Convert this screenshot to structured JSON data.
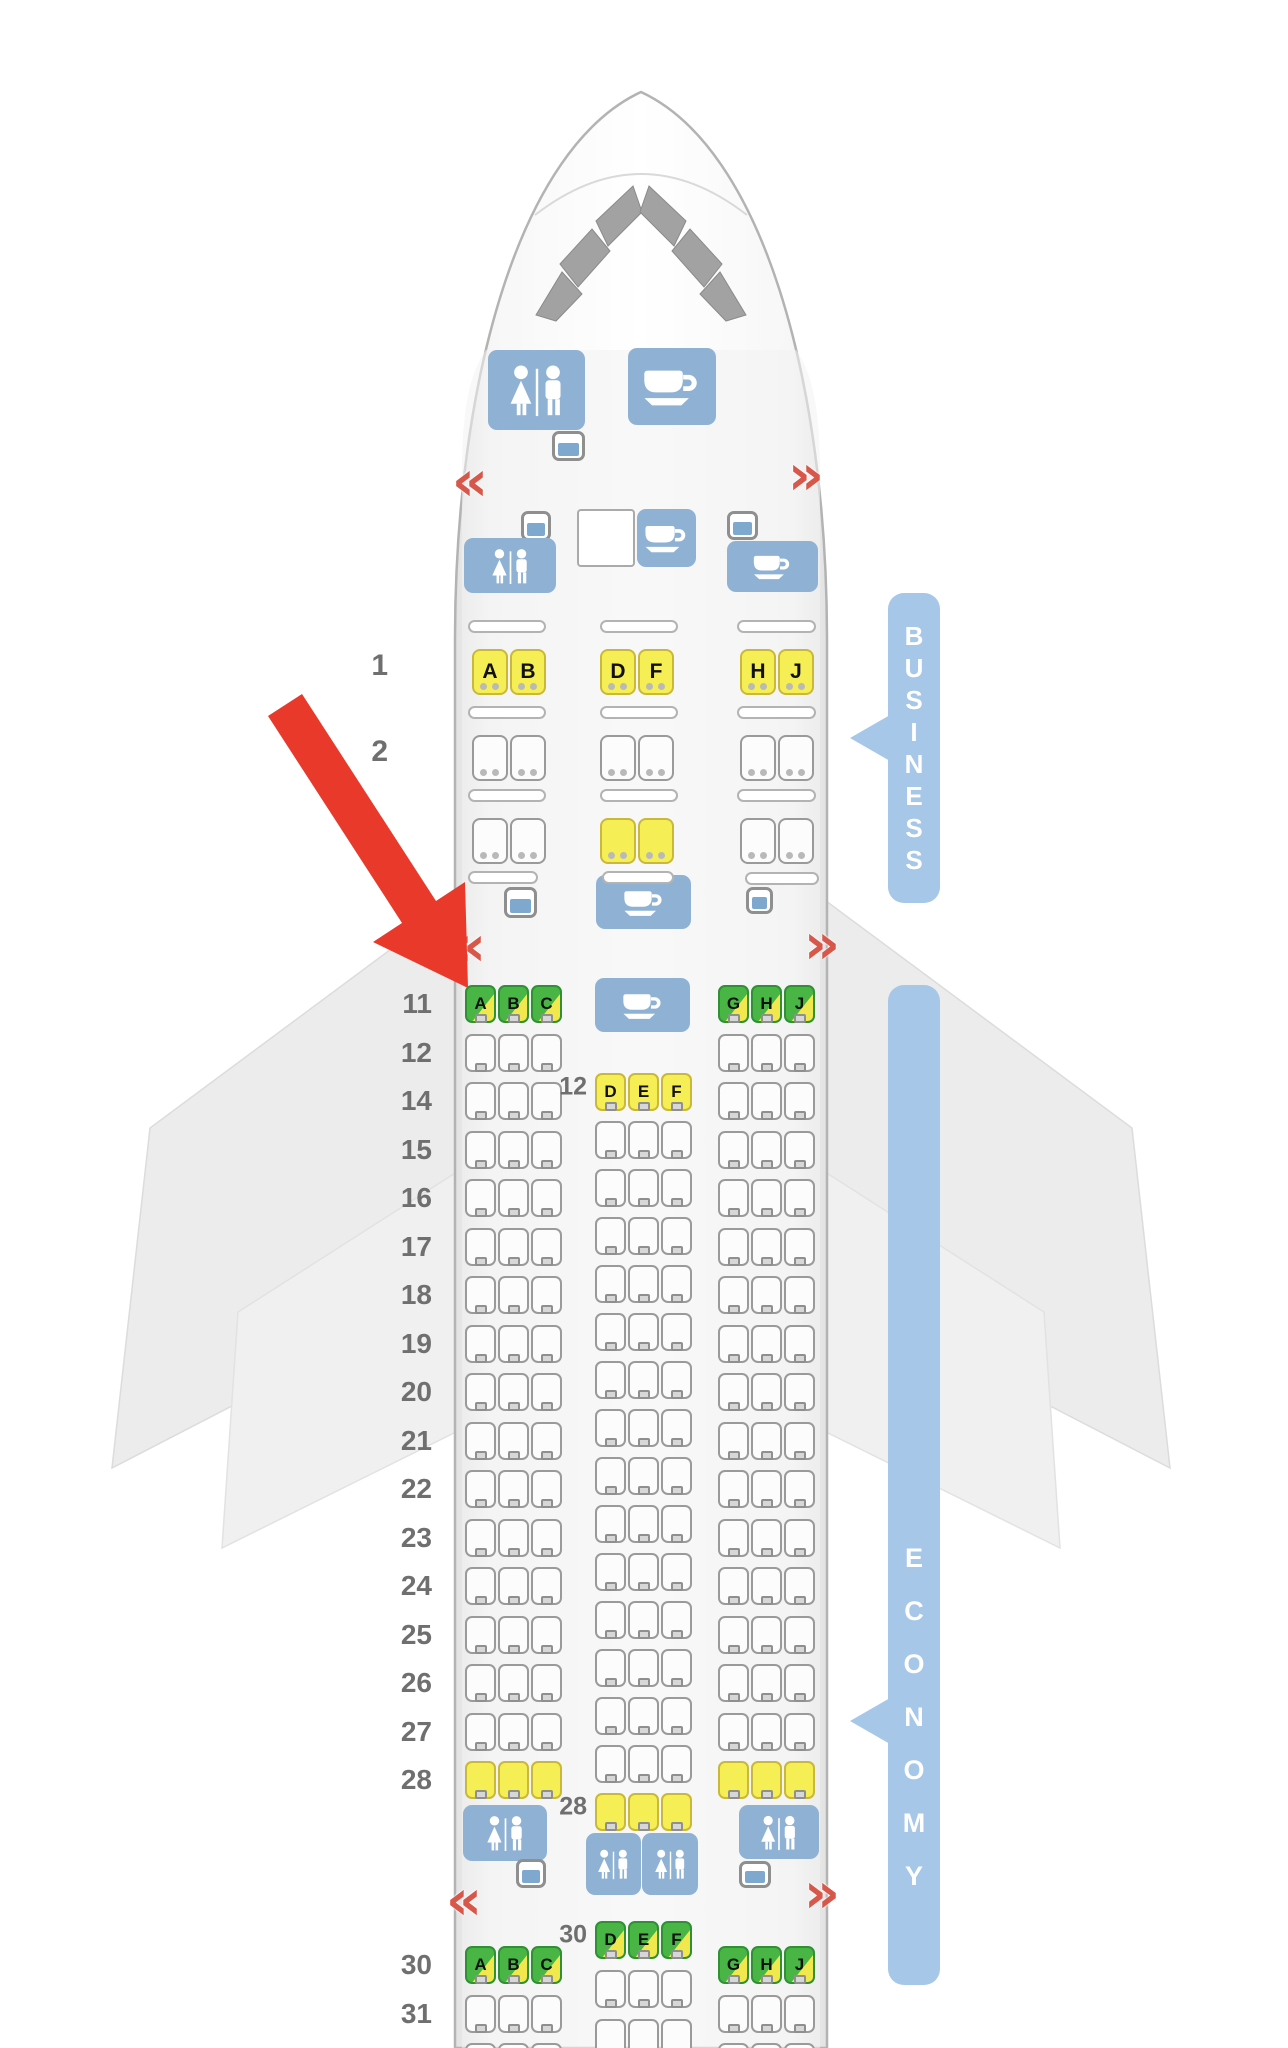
{
  "seat_map": {
    "banners": {
      "business": {
        "label": "BUSINESS",
        "color": "#a7c7e8",
        "text_color": "#ffffff"
      },
      "economy": {
        "label": "ECONOMY",
        "color": "#a7c7e8",
        "text_color": "#ffffff"
      }
    },
    "colors": {
      "seat_green": "#49b545",
      "seat_yellow": "#f6ee55",
      "seat_white": "#fcfcfc",
      "facility_blue": "#8fb2d4",
      "exit_arrow_red": "#d7584a",
      "pointer_arrow_red": "#e8392b",
      "row_label_gray": "#6f6f6f"
    },
    "icons": {
      "lavatory_icon": "woman-and-man-figures",
      "galley_icon": "coffee-cup",
      "closet_icon": "storage-closet",
      "exit_left_glyph": "«",
      "exit_right_glyph": "»"
    },
    "business": {
      "rows": [
        {
          "number": "1",
          "groups": [
            {
              "letters": [
                "A",
                "B"
              ],
              "color": "yellow"
            },
            {
              "letters": [
                "D",
                "F"
              ],
              "color": "yellow"
            },
            {
              "letters": [
                "H",
                "J"
              ],
              "color": "yellow"
            }
          ]
        },
        {
          "number": "2",
          "groups": [
            {
              "letters": null,
              "color": "white"
            },
            {
              "letters": null,
              "color": "white"
            },
            {
              "letters": null,
              "color": "white"
            }
          ]
        },
        {
          "number": "3",
          "groups": [
            {
              "letters": null,
              "color": "white"
            },
            {
              "letters": null,
              "color": "yellow"
            },
            {
              "letters": null,
              "color": "white"
            }
          ]
        }
      ]
    },
    "economy_forward": {
      "side_rows": [
        {
          "number": "11",
          "left_color": "green",
          "right_color": "green",
          "left_labels": [
            "A",
            "B",
            "C"
          ],
          "right_labels": [
            "G",
            "H",
            "J"
          ]
        },
        {
          "number": "12",
          "left_color": "white",
          "right_color": "white"
        },
        {
          "number": "14",
          "left_color": "white",
          "right_color": "white"
        },
        {
          "number": "15",
          "left_color": "white",
          "right_color": "white"
        },
        {
          "number": "16",
          "left_color": "white",
          "right_color": "white"
        },
        {
          "number": "17",
          "left_color": "white",
          "right_color": "white"
        },
        {
          "number": "18",
          "left_color": "white",
          "right_color": "white"
        },
        {
          "number": "19",
          "left_color": "white",
          "right_color": "white"
        },
        {
          "number": "20",
          "left_color": "white",
          "right_color": "white"
        },
        {
          "number": "21",
          "left_color": "white",
          "right_color": "white"
        },
        {
          "number": "22",
          "left_color": "white",
          "right_color": "white"
        },
        {
          "number": "23",
          "left_color": "white",
          "right_color": "white"
        },
        {
          "number": "24",
          "left_color": "white",
          "right_color": "white"
        },
        {
          "number": "25",
          "left_color": "white",
          "right_color": "white"
        },
        {
          "number": "26",
          "left_color": "white",
          "right_color": "white"
        },
        {
          "number": "27",
          "left_color": "white",
          "right_color": "white"
        },
        {
          "number": "28",
          "left_color": "yellow",
          "right_color": "yellow"
        }
      ],
      "center_rows": [
        {
          "label": "12",
          "color": "yellow",
          "letters": [
            "D",
            "E",
            "F"
          ]
        },
        {
          "color": "white"
        },
        {
          "color": "white"
        },
        {
          "color": "white"
        },
        {
          "color": "white"
        },
        {
          "color": "white"
        },
        {
          "color": "white"
        },
        {
          "color": "white"
        },
        {
          "color": "white"
        },
        {
          "color": "white"
        },
        {
          "color": "white"
        },
        {
          "color": "white"
        },
        {
          "color": "white"
        },
        {
          "color": "white"
        },
        {
          "color": "white"
        },
        {
          "label": "28",
          "color": "yellow"
        }
      ]
    },
    "economy_aft": {
      "side_rows": [
        {
          "number": "30",
          "left_color": "green",
          "right_color": "green",
          "left_labels": [
            "A",
            "B",
            "C"
          ],
          "right_labels": [
            "G",
            "H",
            "J"
          ]
        },
        {
          "number": "31",
          "left_color": "white",
          "right_color": "white"
        },
        {
          "number": "",
          "left_color": "white",
          "right_color": "white",
          "partial": true
        }
      ],
      "center_rows": [
        {
          "label": "30",
          "color": "green",
          "letters": [
            "D",
            "E",
            "F"
          ]
        },
        {
          "color": "white"
        },
        {
          "color": "white",
          "partial": true
        }
      ]
    }
  }
}
